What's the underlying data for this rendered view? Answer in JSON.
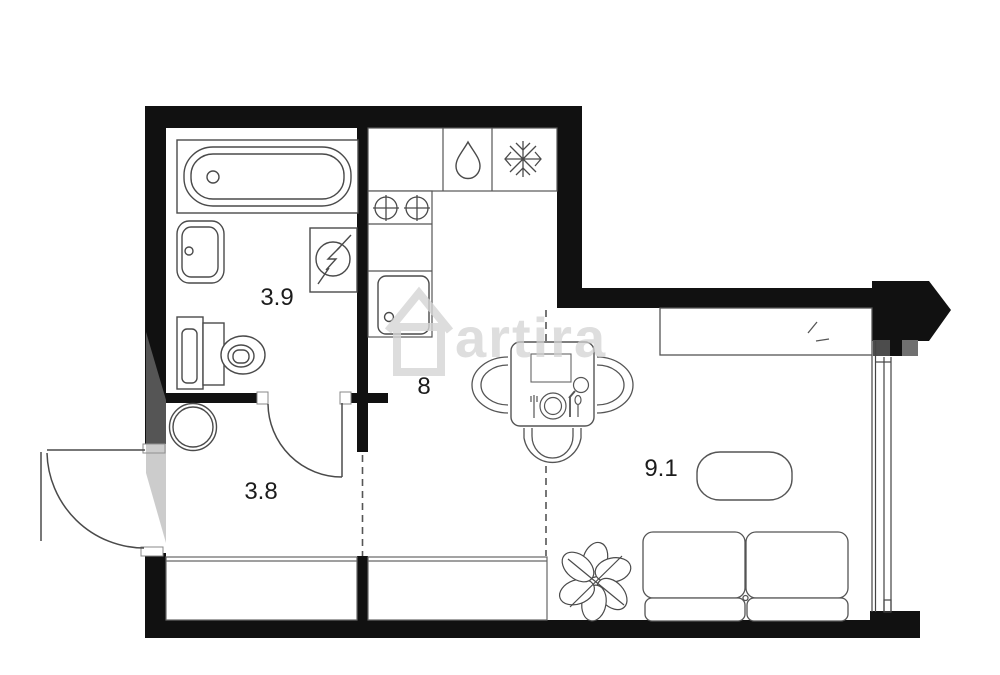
{
  "floor_plan": {
    "title": "studio-apartment-floor-plan",
    "rooms": [
      {
        "id": "bathroom",
        "label": "3.9"
      },
      {
        "id": "kitchen",
        "label": "8"
      },
      {
        "id": "hallway",
        "label": "3.8"
      },
      {
        "id": "living-room",
        "label": "9.1"
      }
    ],
    "watermark": "artira",
    "colors": {
      "wall": "#111111",
      "line": "#4a4a4a",
      "furniture_line": "#555555",
      "background": "#ffffff",
      "watermark": "#d2d2d2",
      "pilaster_gray_dark": "#4c4c4c",
      "pilaster_gray_light": "#707070"
    },
    "fixtures": [
      "bathtub",
      "wash-basin",
      "toilet",
      "water-heater",
      "washing-machine",
      "stove-burners",
      "kitchen-counter",
      "kitchen-sink",
      "dishwasher-drop",
      "fridge-snowflake",
      "dining-table",
      "chair",
      "plate-and-cutlery",
      "wardrobe",
      "coffee-table",
      "sofa",
      "plant",
      "entrance-door",
      "bathroom-door",
      "window",
      "low-window-strip"
    ]
  }
}
